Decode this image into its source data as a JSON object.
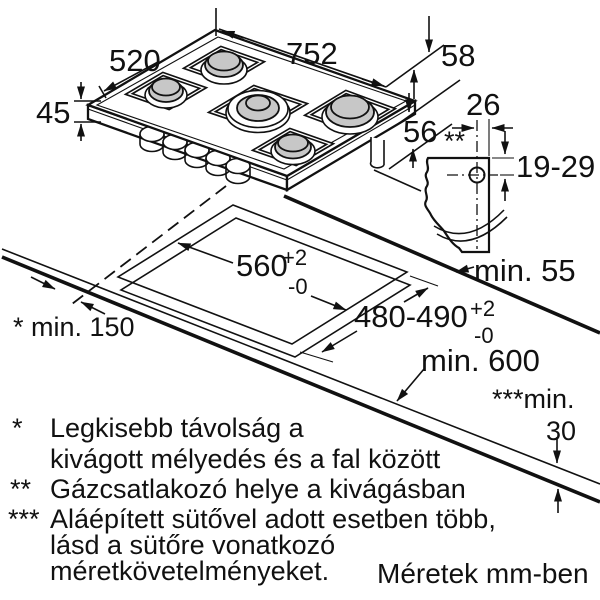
{
  "diagram": {
    "hob": {
      "width": "752",
      "depth": "520",
      "height": "45",
      "rear_edge": "58",
      "below_top": "56"
    },
    "gas_detail": {
      "offset": "26",
      "marker": "**",
      "range": "19-29",
      "side_clearance": "min. 55"
    },
    "cutout": {
      "width": "560",
      "width_tol_plus": "+2",
      "width_tol_minus": "-0",
      "depth": "480-490",
      "depth_tol_plus": "+2",
      "depth_tol_minus": "-0",
      "counter_depth": "min. 600",
      "wall_distance": "* min. 150",
      "thickness_label": "***min.",
      "thickness_value": "30"
    },
    "footnotes": [
      {
        "marker": "*",
        "lines": [
          "Legkisebb távolság a",
          "kivágott mélyedés és a fal között"
        ]
      },
      {
        "marker": "**",
        "lines": [
          "Gázcsatlakozó helye a kivágásban"
        ]
      },
      {
        "marker": "***",
        "lines": [
          "Aláépített sütővel adott esetben több,",
          "lásd a sütőre vonatkozó",
          "méretkövetelményeket."
        ]
      }
    ],
    "caption": "Méretek mm-ben"
  }
}
